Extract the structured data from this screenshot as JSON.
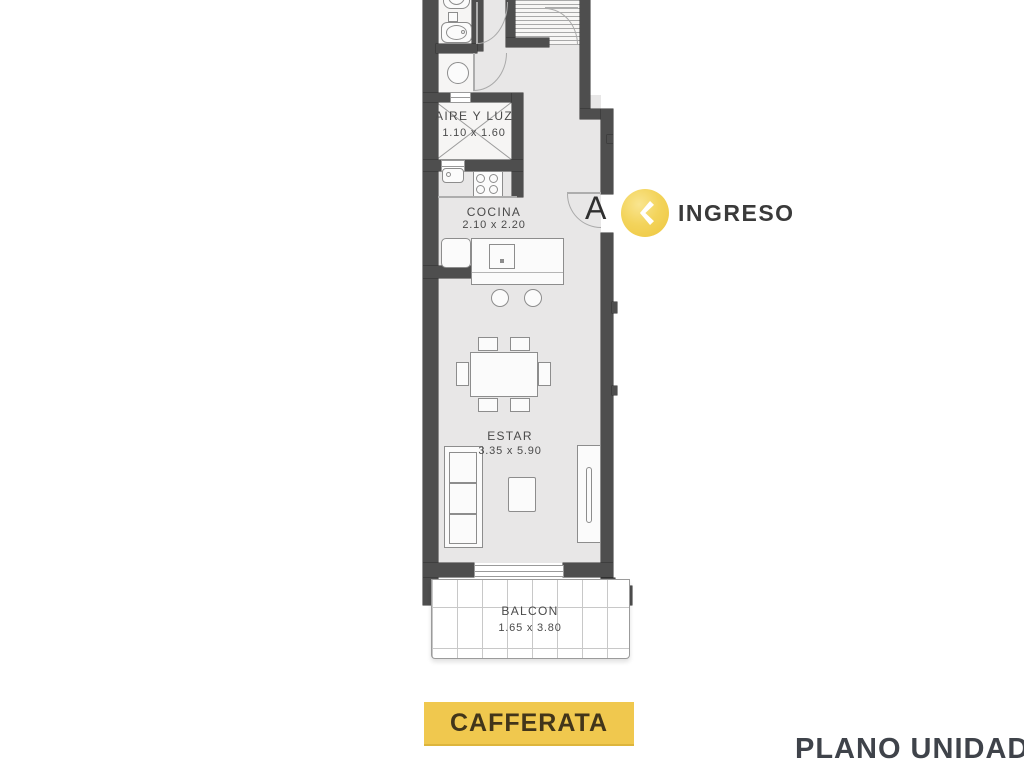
{
  "plan": {
    "rooms": {
      "aire_y_luz": {
        "label": "AIRE Y LUZ",
        "dims": "1.10 x 1.60"
      },
      "cocina": {
        "label": "COCINA",
        "dims": "2.10 x 2.20"
      },
      "estar": {
        "label": "ESTAR",
        "dims": "3.35 x 5.90"
      },
      "balcon": {
        "label": "BALCON",
        "dims": "1.65 x 3.80"
      }
    },
    "entry": {
      "door_letter": "A",
      "label": "INGRESO",
      "icon": "chevron-left-icon"
    }
  },
  "footer": {
    "brand": "CAFFERATA",
    "caption": "PLANO UNIDAD"
  },
  "colors": {
    "wall": "#4e4e4e",
    "floor": "#e8e7e7",
    "accent_yellow": "#f0c84e",
    "marker_yellow": "#eec63e",
    "label_text": "#4a4a4a",
    "title_text": "#3f434a",
    "brand_text": "#42351a"
  }
}
